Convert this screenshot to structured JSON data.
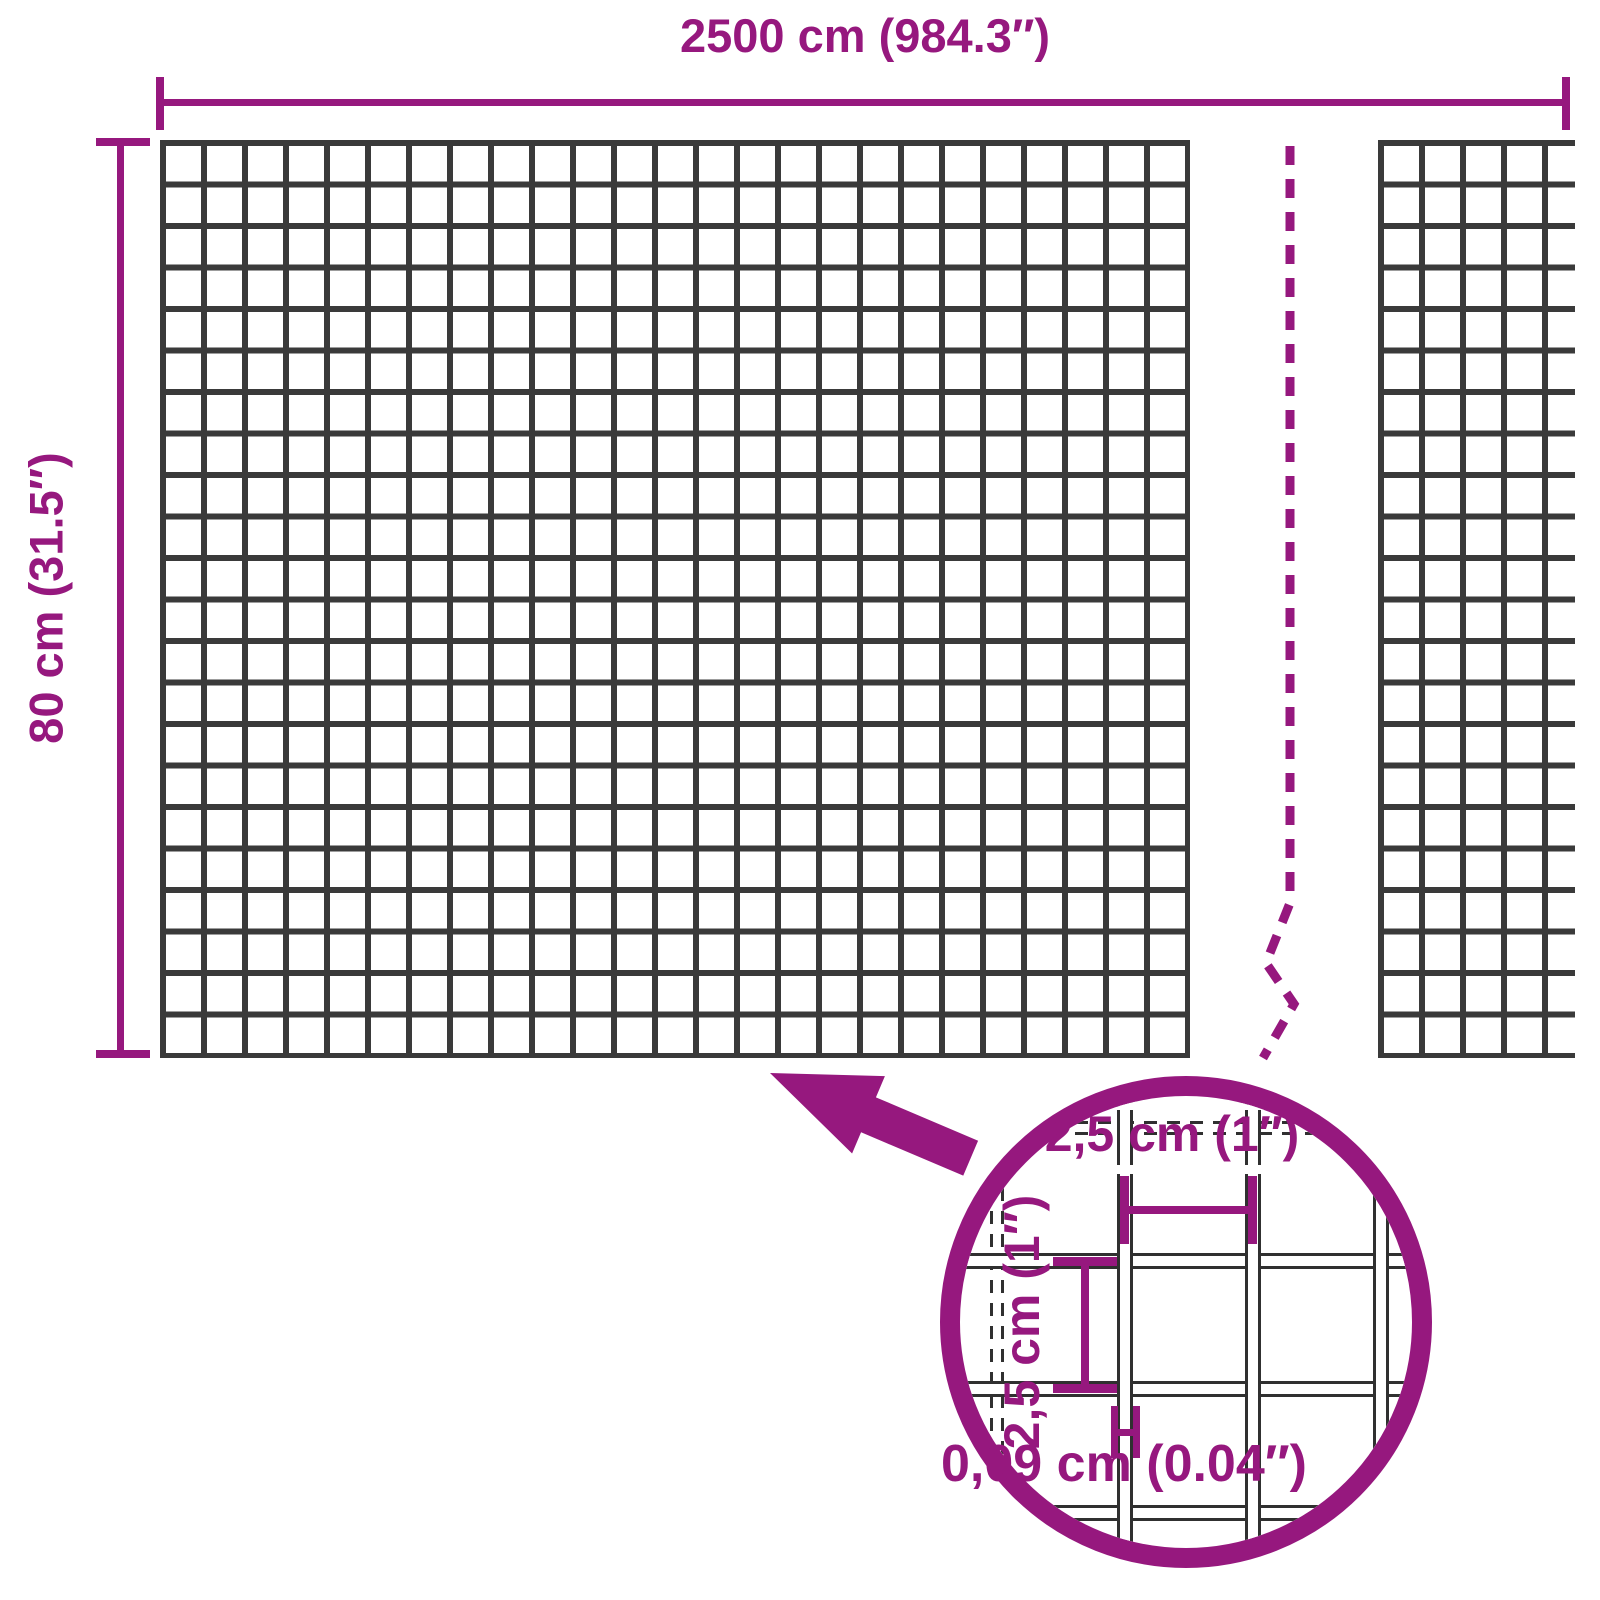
{
  "diagram": {
    "title": "Wire mesh dimensions diagram",
    "dimensions": {
      "width_label": "2500 cm (984.3″)",
      "height_label": "80 cm (31.5″)"
    },
    "detail": {
      "cell_width_label": "2,5 cm (1″)",
      "cell_height_label": "2,5 cm (1″)",
      "wire_thickness_label": "0,09 cm (0.04″)"
    },
    "colors": {
      "accent": "#96187E",
      "grid_line": "#3A3A3A",
      "detail_line": "#303030",
      "background": "#FFFFFF"
    }
  }
}
